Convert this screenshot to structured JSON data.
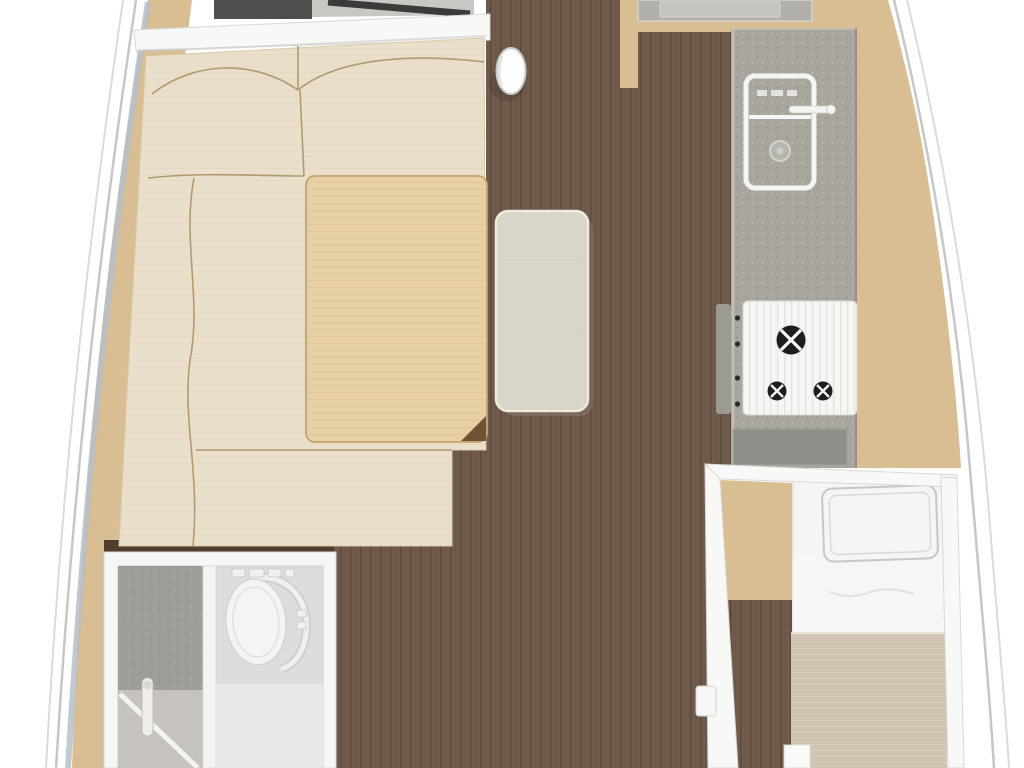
{
  "page": {
    "title": "Sailboat interior floor plan — top-down midship section with salon, galley, head and aft cabin"
  },
  "rooms": {
    "salon": {
      "label": "Salon with L-shaped cream settee, convertible berth pad and saloon table"
    },
    "galley": {
      "label": "Galley with sink, faucet and three-burner gimbaled stove"
    },
    "head": {
      "label": "Head compartment with shower stall and marine toilet"
    },
    "aft_cabin": {
      "label": "Aft cabin with single berth, pillow and blanket"
    },
    "companionway": {
      "label": "Walnut cabin sole walkway"
    },
    "mast": {
      "label": "Mast compression post"
    }
  },
  "colors": {
    "background": "#ffffff",
    "hull_line": "#c7c7c7",
    "hull_line_faint": "#dbdbdb",
    "deck_stripe_blue": "#b5bfc8",
    "deck_wood": "#d9bd93",
    "sole_walnut": "#6f5a4b",
    "sole_walnut_line": "#5c4a3e",
    "bulkhead_white": "#f8f8f6",
    "wall_edge": "#d8d8d6",
    "forward_cabinet": "#4e4e4c",
    "nav_gray": "#c8c7c3",
    "nav_step": "#3b3b39",
    "mast_white": "#fdfdfd",
    "mast_shadow": "#4f4236",
    "sofa_cream": "#eadfcb",
    "sofa_weave": "#e0d2b8",
    "sofa_seam": "#a98e5f",
    "pad_tan": "#e7cfa6",
    "pad_stripe": "#ddc295",
    "pad_border": "#c3a26e",
    "pad_fold": "#6e5233",
    "table_top": "#d9d5cb",
    "table_edge": "#f0eadb",
    "table_shadow": "#8f8172",
    "counter_gray": "#a8a69e",
    "counter_speck_light": "#c1bfb7",
    "counter_speck_dark": "#8d8b83",
    "counter_edge": "#cbc5b6",
    "counter_aft": "#908e88",
    "sink_white": "#f5f5f3",
    "stove_white": "#f6f6f4",
    "stove_stripe": "#e4e2dc",
    "burner_black": "#1d1d1b",
    "gimbal_gray": "#9c9a94",
    "knob_black": "#2a2a28",
    "head_wall": "#f6f6f4",
    "head_floor": "#dedddb",
    "head_floor_light": "#e9e8e6",
    "shower_gray": "#9f9d97",
    "shower_speck": "#b4b2aa",
    "shower_tray": "#c9c7c1",
    "toilet_white": "#f4f4f2",
    "toilet_rim_shadow": "#cfcdc9",
    "berth_sheet": "#f6f5f3",
    "berth_blanket": "#cfc3b1",
    "blanket_stripe": "#ddd3c3",
    "pillow_trim": "#c6c6c4",
    "dark_bulkhead_strip": "#4f3d2e"
  }
}
